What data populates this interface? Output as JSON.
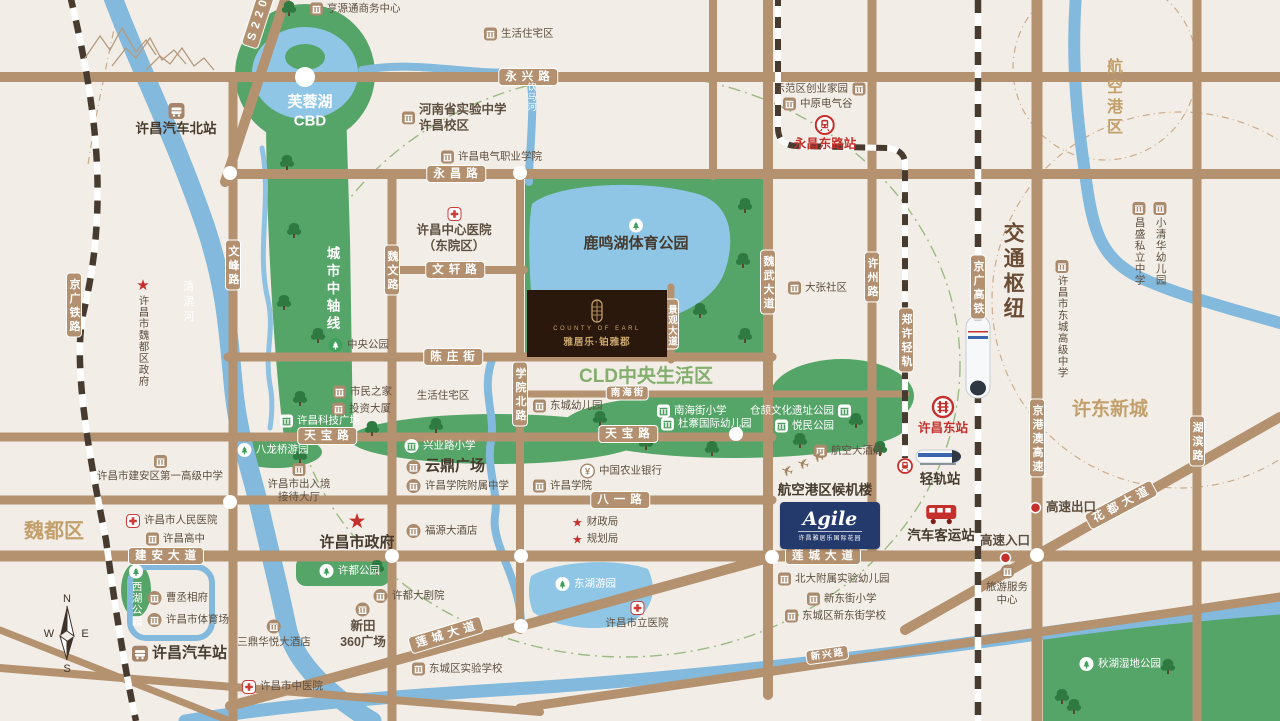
{
  "map": {
    "regions": [
      {
        "id": "weidu-district-label",
        "s": "魏都区",
        "x": 54,
        "y": 532,
        "cls": "gold b20"
      },
      {
        "id": "xudong-new-town-label",
        "s": "许东新城",
        "x": 1110,
        "y": 410,
        "cls": "gold b19"
      },
      {
        "id": "cld-central-living-label",
        "s": "CLD中央生活区",
        "x": 646,
        "y": 377,
        "cls": "green b19"
      },
      {
        "id": "furong-lake-cbd-label",
        "lines": [
          "芙蓉湖",
          "CBD"
        ],
        "x": 310,
        "y": 112,
        "cls": "white b15"
      },
      {
        "id": "airport-zone-label",
        "s": "航空港区",
        "x": 1112,
        "y": 98,
        "cls": "gold b16 vert"
      },
      {
        "id": "transport-hub-label",
        "s": "交通枢纽",
        "x": 1012,
        "y": 272,
        "cls": "brown b21 vert"
      },
      {
        "id": "city-axis-label",
        "s": "城市中轴线",
        "x": 331,
        "y": 290,
        "cls": "white b14 vert"
      },
      {
        "id": "qingyi-river-label",
        "s": "清潩河",
        "x": 187,
        "y": 303,
        "cls": "white s11 vert"
      },
      {
        "id": "yinma-river-label",
        "s": "饮马河",
        "x": 531,
        "y": 97,
        "cls": "white s9 vert"
      }
    ],
    "road_labels": [
      {
        "id": "yongxing-road",
        "s": "永兴路",
        "x": 528,
        "y": 77
      },
      {
        "id": "yongchang-road",
        "s": "永昌路",
        "x": 456,
        "y": 174
      },
      {
        "id": "wenxuan-road",
        "s": "文轩路",
        "x": 455,
        "y": 270
      },
      {
        "id": "chenzhuang-street",
        "s": "陈庄街",
        "x": 453,
        "y": 357
      },
      {
        "id": "nanhai-street",
        "s": "南海街",
        "x": 627,
        "y": 393,
        "sm": 1
      },
      {
        "id": "tianbao-road-w",
        "s": "天宝路",
        "x": 327,
        "y": 436
      },
      {
        "id": "tianbao-road-e",
        "s": "天宝路",
        "x": 628,
        "y": 434
      },
      {
        "id": "bayi-road",
        "s": "八一路",
        "x": 620,
        "y": 500
      },
      {
        "id": "jianan-avenue",
        "s": "建安大道",
        "x": 166,
        "y": 556
      },
      {
        "id": "liancheng-avenue-e",
        "s": "莲城大道",
        "x": 823,
        "y": 556
      },
      {
        "id": "liancheng-avenue-sw",
        "s": "莲城大道",
        "x": 446,
        "y": 635,
        "rot": -17
      },
      {
        "id": "xinxing-road",
        "s": "新兴路",
        "x": 827,
        "y": 655,
        "rot": -8,
        "sm": 1
      },
      {
        "id": "huadu-avenue",
        "s": "花都大道",
        "x": 1121,
        "y": 505,
        "rot": -28
      },
      {
        "id": "s220",
        "s": "S220",
        "x": 258,
        "y": 20,
        "rot": -72
      }
    ],
    "vroad_labels": [
      {
        "id": "wenfeng-road",
        "s": "文峰路",
        "x": 233,
        "y": 265
      },
      {
        "id": "weiwen-road",
        "s": "魏文路",
        "x": 392,
        "y": 270
      },
      {
        "id": "xueyuan-north-road",
        "s": "学院北路",
        "x": 520,
        "y": 394
      },
      {
        "id": "weiwu-avenue",
        "s": "魏武大道",
        "x": 768,
        "y": 282
      },
      {
        "id": "jingguan-avenue",
        "s": "景观大道",
        "x": 671,
        "y": 324,
        "sm": 1
      },
      {
        "id": "xuzhou-road",
        "s": "许州路",
        "x": 872,
        "y": 277
      },
      {
        "id": "hubin-road",
        "s": "湖滨路",
        "x": 1197,
        "y": 441
      },
      {
        "id": "jinggang-ao-expressway",
        "s": "京港澳高速",
        "x": 1037,
        "y": 438
      },
      {
        "id": "jingguang-railway",
        "s": "京广铁路",
        "x": 74,
        "y": 305
      },
      {
        "id": "jingguang-hsr",
        "s": "京广高铁",
        "x": 978,
        "y": 287
      },
      {
        "id": "zhengxu-lrt",
        "s": "郑许轻轨",
        "x": 906,
        "y": 340
      }
    ],
    "pois": [
      {
        "id": "hengyuantong-business-center",
        "t": "bldg",
        "x": 318,
        "y": 9,
        "s": "亨源通商务中心"
      },
      {
        "id": "residential-area-north",
        "t": "bldg",
        "x": 492,
        "y": 34,
        "s": "生活住宅区"
      },
      {
        "id": "henan-experimental-school",
        "t": "bldg",
        "x": 410,
        "y": 118,
        "lines": [
          "河南省实验中学",
          "许昌校区"
        ],
        "cls": "b13"
      },
      {
        "id": "xuchang-electric-college",
        "t": "bldg",
        "x": 449,
        "y": 157,
        "s": "许昌电气职业学院"
      },
      {
        "id": "demo-zone-startup-homes",
        "t": "bldg",
        "x": 857,
        "y": 89,
        "s": "示范区创业家园",
        "lp": "l"
      },
      {
        "id": "central-china-electric-valley",
        "t": "bldg",
        "x": 791,
        "y": 104,
        "s": "中原电气谷"
      },
      {
        "id": "yongchang-east-road-station",
        "t": "metro",
        "x": 825,
        "y": 124,
        "s": "永昌东路站",
        "lp": "b",
        "cls": "b13 red"
      },
      {
        "id": "xuchang-north-bus-station",
        "t": "bus",
        "x": 176,
        "y": 112,
        "s": "许昌汽车北站",
        "lp": "b",
        "cls": "b14"
      },
      {
        "id": "changsheng-private-school",
        "t": "bldg",
        "x": 1139,
        "y": 211,
        "s": "昌盛私立中学",
        "lp": "bv"
      },
      {
        "id": "xiaoqinghua-kindergarten",
        "t": "bldg",
        "x": 1160,
        "y": 211,
        "s": "小清华幼儿园",
        "lp": "bv"
      },
      {
        "id": "dongcheng-senior-high",
        "t": "bldg",
        "x": 1062,
        "y": 269,
        "s": "许昌市东城高级中学",
        "lp": "bv"
      },
      {
        "id": "weidu-district-government",
        "t": "star",
        "x": 143,
        "y": 287,
        "s": "许昌市魏都区政府",
        "lp": "bv"
      },
      {
        "id": "xuchang-central-hospital",
        "t": "hosp",
        "x": 454,
        "y": 216,
        "lines": [
          "许昌中心医院",
          "（东院区）"
        ],
        "lp": "b",
        "cls": "b13"
      },
      {
        "id": "dazhang-community",
        "t": "bldg",
        "x": 796,
        "y": 288,
        "s": "大张社区"
      },
      {
        "id": "central-park",
        "t": "parkc",
        "x": 336,
        "y": 345,
        "s": "中央公园"
      },
      {
        "id": "citizens-home",
        "t": "bldg",
        "x": 341,
        "y": 392,
        "s": "市民之家"
      },
      {
        "id": "investment-building",
        "t": "bldg",
        "x": 340,
        "y": 409,
        "s": "投资大厦"
      },
      {
        "id": "keji-plaza",
        "t": "bldgw",
        "x": 288,
        "y": 421,
        "s": "许昌科技广场",
        "cls": "white"
      },
      {
        "id": "residential-area-mid",
        "t": "none",
        "x": 443,
        "y": 396,
        "s": "生活住宅区",
        "lp": "c",
        "cls": "mut"
      },
      {
        "id": "dongcheng-kindergarten",
        "t": "bldg",
        "x": 541,
        "y": 406,
        "s": "东城幼儿园"
      },
      {
        "id": "nanhai-street-primary",
        "t": "bldgw",
        "x": 665,
        "y": 411,
        "s": "南海街小学",
        "cls": "white"
      },
      {
        "id": "duzhai-intl-kindergarten",
        "t": "bldgw",
        "x": 669,
        "y": 424,
        "s": "杜寨国际幼儿园",
        "cls": "white"
      },
      {
        "id": "cangjie-culture-park",
        "t": "bldgw",
        "x": 843,
        "y": 411,
        "s": "仓颉文化遗址公园",
        "lp": "l",
        "cls": "white"
      },
      {
        "id": "yuemin-park",
        "t": "bldgw",
        "x": 783,
        "y": 426,
        "s": "悦民公园",
        "cls": "white"
      },
      {
        "id": "xingye-road-primary",
        "t": "schoolw",
        "x": 412,
        "y": 446,
        "s": "兴业路小学",
        "cls": "white"
      },
      {
        "id": "balongqiao-garden",
        "t": "parkw",
        "x": 245,
        "y": 450,
        "s": "八龙桥游园",
        "cls": "white"
      },
      {
        "id": "luminghu-sports-park",
        "t": "parkw",
        "x": 636,
        "y": 227,
        "s": "鹿鸣湖体育公园",
        "lp": "b",
        "cls": "white b15"
      },
      {
        "id": "entry-exit-hall",
        "t": "bldg",
        "x": 299,
        "y": 472,
        "lines": [
          "许昌市出入境",
          "接待大厅"
        ],
        "lp": "b"
      },
      {
        "id": "yunding-plaza",
        "t": "bldgc",
        "x": 414,
        "y": 467,
        "s": "云鼎广场",
        "cls": "b15"
      },
      {
        "id": "xuchang-college-affiliated-ms",
        "t": "bldgc",
        "x": 414,
        "y": 486,
        "s": "许昌学院附属中学"
      },
      {
        "id": "xuchang-college",
        "t": "bldg",
        "x": 541,
        "y": 486,
        "s": "许昌学院"
      },
      {
        "id": "agricultural-bank",
        "t": "bank",
        "x": 588,
        "y": 471,
        "s": "中国农业银行"
      },
      {
        "id": "aviation-hotel",
        "t": "bldg",
        "x": 822,
        "y": 451,
        "s": "航空大酒店"
      },
      {
        "id": "airport-terminal",
        "t": "none",
        "x": 825,
        "y": 491,
        "s": "航空港区候机楼",
        "lp": "c",
        "cls": "b14 dark"
      },
      {
        "id": "plane-1",
        "t": "plane",
        "x": 787,
        "y": 471,
        "lp": "c"
      },
      {
        "id": "plane-2",
        "t": "plane",
        "x": 803,
        "y": 464,
        "lp": "c"
      },
      {
        "id": "plane-3",
        "t": "plane",
        "x": 818,
        "y": 457,
        "lp": "c"
      },
      {
        "id": "finance-bureau",
        "t": "starsm",
        "x": 580,
        "y": 522,
        "s": "财政局"
      },
      {
        "id": "planning-bureau",
        "t": "starsm",
        "x": 580,
        "y": 539,
        "s": "规划局"
      },
      {
        "id": "xuchang-city-government",
        "t": "starlg",
        "x": 357,
        "y": 520,
        "s": "许昌市政府",
        "lp": "b",
        "cls": "b15"
      },
      {
        "id": "fuyuan-hotel",
        "t": "bldgc",
        "x": 414,
        "y": 531,
        "s": "福源大酒店"
      },
      {
        "id": "xuchang-high-school",
        "t": "bldg",
        "x": 154,
        "y": 539,
        "s": "许昌高中"
      },
      {
        "id": "peoples-hospital",
        "t": "hosp",
        "x": 134,
        "y": 521,
        "s": "许昌市人民医院"
      },
      {
        "id": "jianan-no1-high",
        "t": "bldg",
        "x": 160,
        "y": 464,
        "s": "许昌市建安区第一高级中学",
        "lp": "b"
      },
      {
        "id": "cao-mansion",
        "t": "bldgc",
        "x": 155,
        "y": 598,
        "s": "曹丞相府"
      },
      {
        "id": "xuchang-stadium",
        "t": "bldgc",
        "x": 155,
        "y": 620,
        "s": "许昌市体育场"
      },
      {
        "id": "xihu-park",
        "t": "parkw",
        "x": 136,
        "y": 573,
        "s": "西湖公园",
        "lp": "bv",
        "cls": "white"
      },
      {
        "id": "xuchang-bus-station",
        "t": "bus",
        "x": 140,
        "y": 654,
        "s": "许昌汽车站",
        "lp": "r",
        "cls": "b15"
      },
      {
        "id": "sanding-huayue-hotel",
        "t": "bldgc",
        "x": 274,
        "y": 628,
        "s": "三鼎华悦大酒店",
        "lp": "b"
      },
      {
        "id": "tcm-hospital",
        "t": "hosp",
        "x": 250,
        "y": 687,
        "s": "许昌市中医院"
      },
      {
        "id": "xudu-park",
        "t": "parkw",
        "x": 327,
        "y": 571,
        "s": "许都公园",
        "cls": "white"
      },
      {
        "id": "xudu-theater",
        "t": "bldgc",
        "x": 381,
        "y": 596,
        "s": "许都大剧院"
      },
      {
        "id": "xintian-360-plaza",
        "t": "bldgc",
        "x": 363,
        "y": 611,
        "lines": [
          "新田",
          "360广场"
        ],
        "lp": "b",
        "cls": "b13"
      },
      {
        "id": "dongcheng-experimental-school",
        "t": "bldg",
        "x": 420,
        "y": 669,
        "s": "东城区实验学校"
      },
      {
        "id": "donghu-garden",
        "t": "parkw",
        "x": 563,
        "y": 584,
        "s": "东湖游园",
        "cls": "white"
      },
      {
        "id": "city-hospital",
        "t": "hosp",
        "x": 637,
        "y": 610,
        "s": "许昌市立医院",
        "lp": "b"
      },
      {
        "id": "pku-affiliated-kindergarten",
        "t": "bldg",
        "x": 786,
        "y": 579,
        "s": "北大附属实验幼儿园"
      },
      {
        "id": "xindong-street-primary",
        "t": "bldg",
        "x": 815,
        "y": 599,
        "s": "新东街小学"
      },
      {
        "id": "dongcheng-xindong-school",
        "t": "bldg",
        "x": 793,
        "y": 616,
        "s": "东城区新东街学校"
      },
      {
        "id": "tourist-service-center",
        "t": "bldgc",
        "x": 1007,
        "y": 573,
        "lines": [
          "旅游服务",
          "中心"
        ],
        "lp": "b"
      },
      {
        "id": "qiuhu-wetland-park",
        "t": "parkw",
        "x": 1087,
        "y": 664,
        "s": "秋湖湿地公园",
        "cls": "white"
      },
      {
        "id": "xuchang-east-station",
        "t": "railway",
        "x": 943,
        "y": 404,
        "s": "许昌东站",
        "lp": "b",
        "cls": "b13 red"
      },
      {
        "id": "lrt-station-marker",
        "t": "metrosm",
        "x": 905,
        "y": 466,
        "lp": "c"
      },
      {
        "id": "lrt-station",
        "t": "none",
        "x": 940,
        "y": 480,
        "s": "轻轨站",
        "lp": "c",
        "cls": "b14 dark"
      },
      {
        "id": "coach-station",
        "t": "redbus",
        "x": 941,
        "y": 512,
        "s": "汽车客运站",
        "lp": "b",
        "cls": "b14 dark"
      },
      {
        "id": "expressway-exit",
        "t": "reddot",
        "x": 1037,
        "y": 508,
        "s": "高速出口",
        "cls": "b13"
      },
      {
        "id": "expressway-entry",
        "t": "reddot",
        "x": 1005,
        "y": 555,
        "s": "高速入口",
        "lp": "t",
        "cls": "b13"
      }
    ],
    "project": {
      "en": "COUNTY OF EARL",
      "cn": "雅居乐·铂雅郡"
    },
    "agile": {
      "brand": "Agile",
      "sub": "许昌雅居乐国际花园"
    },
    "compass": {
      "n": "N",
      "w": "W",
      "e": "E",
      "s": "S"
    }
  }
}
